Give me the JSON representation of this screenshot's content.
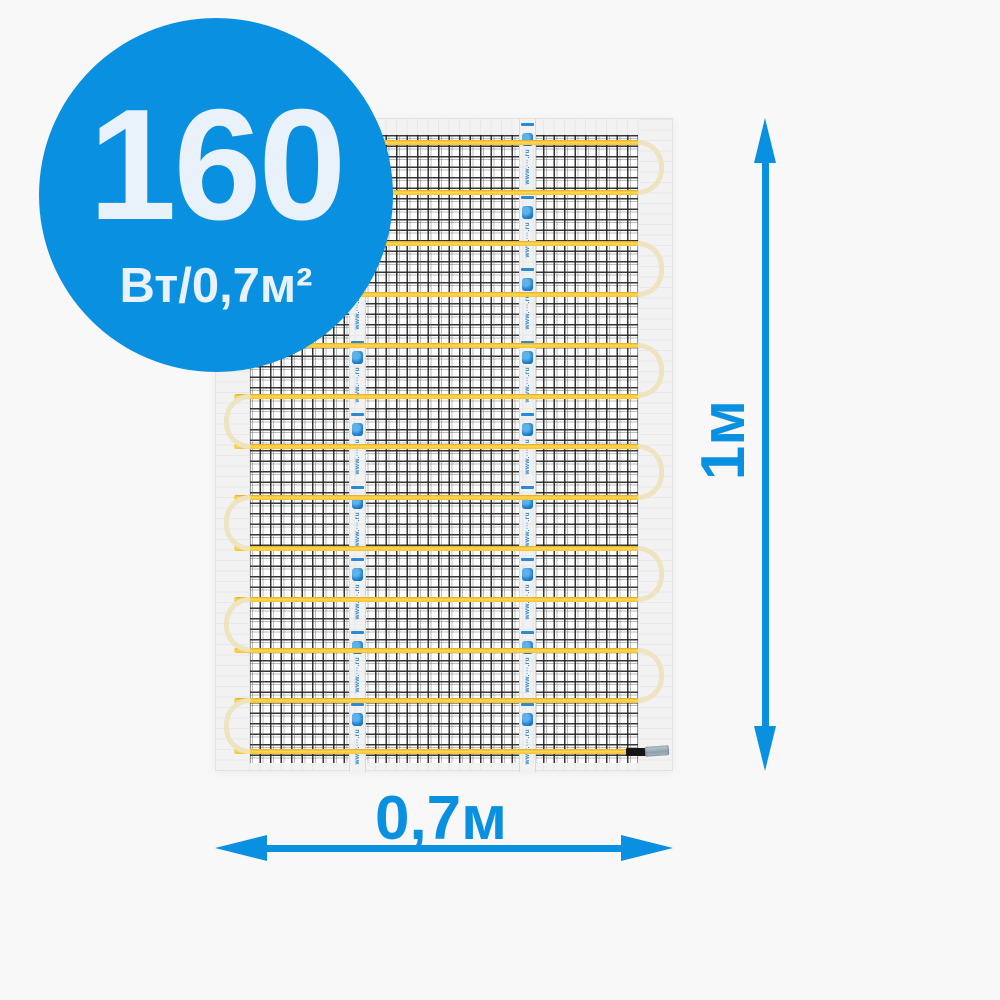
{
  "product_badge": {
    "value": "160",
    "unit": "Вт/0,7м²"
  },
  "dimensions": {
    "height_label": "1м",
    "width_label": "0,7м"
  },
  "mat_tape": {
    "url_text": "www.···.ru"
  },
  "colors": {
    "accent_blue": "#0a90e1",
    "badge_text": "#e9f2fb",
    "cable_yellow": "#ffd94f",
    "cable_turn_cream": "#efe4c2",
    "mesh_line": "#202020",
    "background": "#f8f8f8"
  }
}
